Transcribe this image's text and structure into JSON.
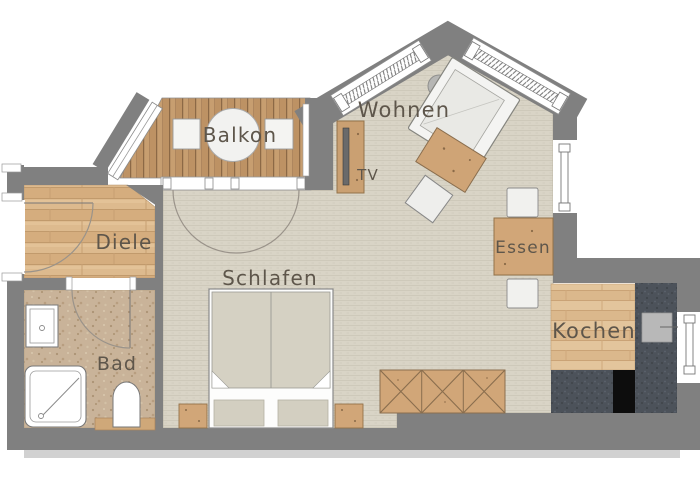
{
  "plan_title": "Apartment floor plan",
  "rooms": [
    {
      "id": "balkon",
      "label": "Balkon"
    },
    {
      "id": "wohnen",
      "label": "Wohnen"
    },
    {
      "id": "tv",
      "label": "TV"
    },
    {
      "id": "diele",
      "label": "Diele"
    },
    {
      "id": "schlafen",
      "label": "Schlafen"
    },
    {
      "id": "bad",
      "label": "Bad"
    },
    {
      "id": "essen",
      "label": "Essen"
    },
    {
      "id": "kochen",
      "label": "Kochen"
    }
  ],
  "palette": {
    "wall_gray": "#808080",
    "carpet": "#d9d4c6",
    "diele_wood": "#ddba8e",
    "kitchen_wood": "#e3c59c",
    "deck_wood": "#c79e70",
    "bath_floor": "#c9b399",
    "furniture_wood": "#d1a678",
    "counter_dark": "#4c525a",
    "appliance_black": "#0d0d0d",
    "fixture_white": "#ffffff",
    "label_text": "#5e564b",
    "shadow": "#c6c6c6"
  },
  "furniture": [
    "balcony-round-table",
    "balcony-seat-left",
    "balcony-seat-right",
    "sofa",
    "coffee-table",
    "pouf",
    "plant",
    "tv-sideboard",
    "dining-table",
    "dining-chair-top",
    "dining-chair-bottom",
    "double-bed",
    "nightstand-left",
    "nightstand-right",
    "wardrobe",
    "kitchen-counter",
    "stove",
    "kitchen-sink",
    "bathroom-sink",
    "shower",
    "toilet"
  ],
  "windows": [
    "bay-window-left",
    "bay-window-right",
    "balcony-side-window",
    "dining-wall-window",
    "kitchen-wall-window",
    "entry-door",
    "balcony-doors",
    "bath-door"
  ]
}
